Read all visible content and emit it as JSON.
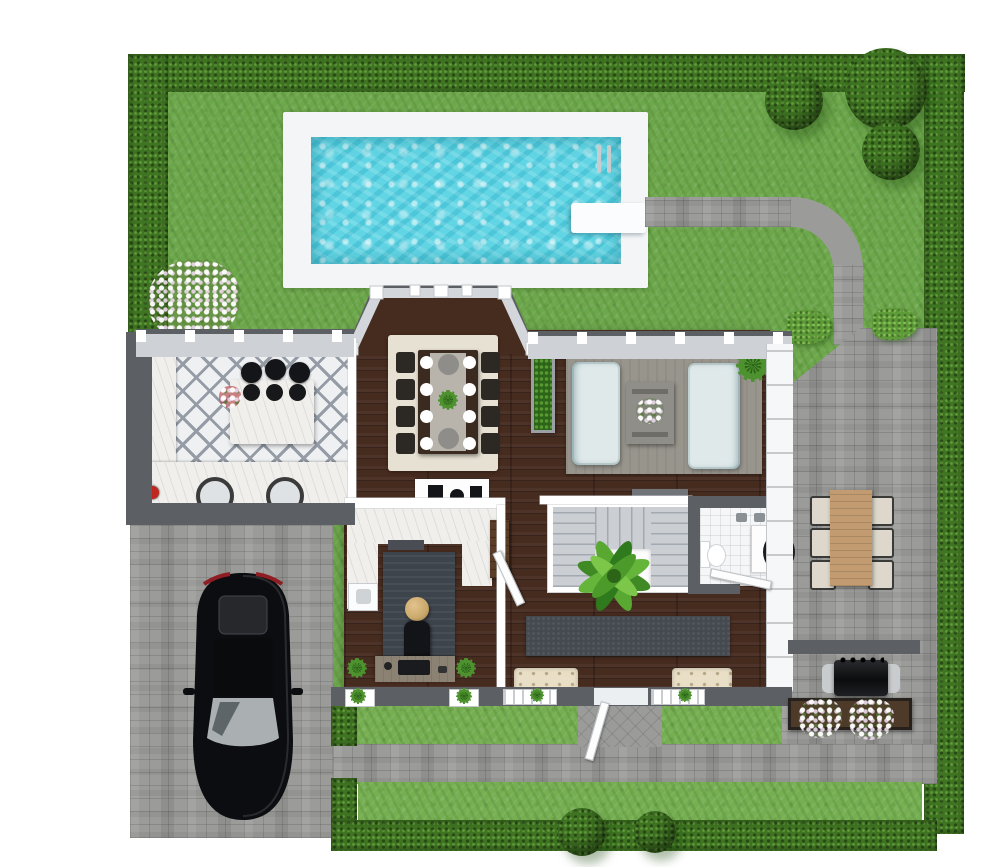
{
  "meta": {
    "description": "Top-down 3D rendered floor plan of a single-story home with landscaped yard, swimming pool, driveway and patio",
    "view": "top-down-3d-render",
    "visible_text": []
  },
  "colors": {
    "lawn": "#6da74b",
    "grassLight": "#76af52",
    "hedge": "#3f7522",
    "hedgeLight": "#5d9a38",
    "poolDeck": "#f3f5f7",
    "poolWater": "#62d5e4",
    "paver": "#9b9b99",
    "wallDark": "#5c6064",
    "windowSill": "#ced2d6",
    "white": "#ffffff",
    "wood": "#462b1f",
    "kitchenTile": "#eef0f2",
    "tileAccent": "#959ca6",
    "rugDining": "#e7e1d3",
    "rugLiving": "#98958d",
    "rugOffice": "#3e444c",
    "runner": "#454a50",
    "sofa": "#dfe9ea",
    "coffeeTable": "#8f8e88",
    "stair": "#cbcfd4",
    "stairLine": "#a3a9b0",
    "bathTile": "#f5f6f8",
    "bench": "#e9dfc7",
    "outdoorWood": "#c29b70",
    "outdoorChair": "#ddd8cb",
    "desk": "#8b8274",
    "gold": "#c9a86a",
    "black": "#111215",
    "carGlass": "#a9aeb1",
    "planter": "#4e3a28",
    "console": "#71757a",
    "cabinet": "#5a3d28",
    "red": "#c0271f",
    "plant": "#4e9230",
    "plantDark": "#2c6418",
    "marble": "#f0efec",
    "steel": "#c9ccce"
  },
  "landscape": {
    "elements": [
      "boxwood-hedge-border",
      "lawn",
      "swimming-pool",
      "pool-deck",
      "diving-board",
      "pool-ladder",
      "curved-paver-path",
      "paver-patio",
      "paver-driveway",
      "front-walkway",
      "blossom-tree",
      "round-topiary-bushes",
      "foundation-shrubs",
      "flower-planter-box",
      "front-grass-strips"
    ],
    "outdoor_furniture": [
      "black-car",
      "outdoor-dining-table",
      "six-outdoor-chairs",
      "bbq-grill"
    ]
  },
  "house": {
    "rooms": [
      "kitchen",
      "dining-room",
      "living-room",
      "home-office",
      "bathroom",
      "entry-hallway",
      "staircase"
    ],
    "kitchen": [
      "diamond-tile-floor",
      "center-island",
      "three-bar-stools",
      "double-sink-counter",
      "side-counter",
      "red-flower-accent"
    ],
    "dining_room": [
      "beige-area-rug",
      "eight-seat-dining-table",
      "place-settings",
      "centerpiece-plant",
      "bay-window",
      "sideboard"
    ],
    "living_room": [
      "gray-area-rug",
      "two-light-sofas",
      "concrete-coffee-table",
      "corner-plant",
      "planter-divider",
      "media-console"
    ],
    "home_office": [
      "dark-area-rug",
      "desk",
      "office-chair",
      "round-gold-table",
      "built-in-counter",
      "washer",
      "corner-plants"
    ],
    "bathroom": [
      "tile-floor",
      "toilet",
      "vanity-sink",
      "round-mirror",
      "towels"
    ],
    "hallway": [
      "dark-runner-rug",
      "two-entry-benches",
      "palm-plant",
      "front-door",
      "wardrobe-cabinet"
    ]
  }
}
